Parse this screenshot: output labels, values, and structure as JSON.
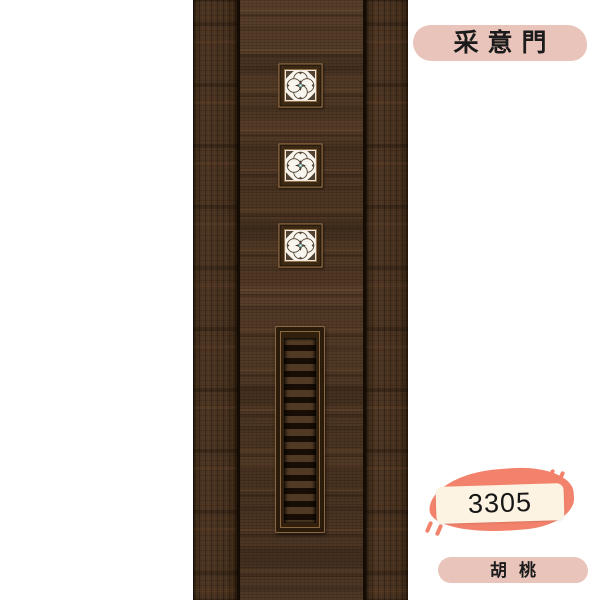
{
  "page": {
    "background_color": "#ffffff"
  },
  "labels": {
    "brand": "采意門",
    "product_code": "3305",
    "wood_type": "胡桃"
  },
  "door": {
    "description": "dark walnut door with three flower-lattice glass windows and a louvered vent panel",
    "window_count": 3,
    "vent_slat_count": 15,
    "colors": {
      "wood_base": "#4a3422",
      "wood_dark": "#2c1b0d",
      "groove": "#1a0f06",
      "frame_trim": "#8a6740",
      "glass": "#f8f5ee",
      "glass_accent": "#7db2b2"
    }
  },
  "badges": {
    "pill_color": "#e8c4ba",
    "card_color": "#fdf3e2",
    "blob_color": "#f2826b",
    "text_color": "#1b1b1b"
  }
}
